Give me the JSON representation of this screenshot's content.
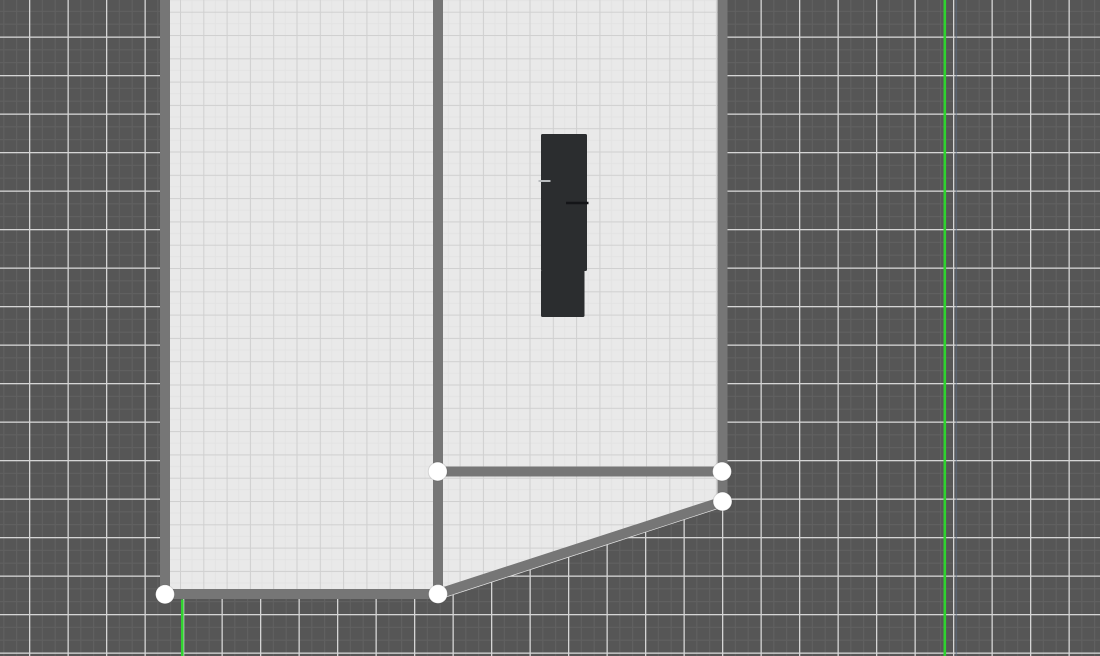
{
  "app": {
    "name": "floor-plan-editor",
    "view_label": "2d-plan-canvas"
  },
  "colors": {
    "workspace_base": "#565656",
    "workspace_minor_grid": "#616161",
    "workspace_major_grid": "#d5d5d5",
    "floor_base": "#e9e9e9",
    "floor_grid": "#d0d0d0",
    "floor_subgrid": "#e2e2e2",
    "wall": "#767676",
    "handle_fill": "#ffffff",
    "handle_edge": "rgba(0,0,0,0.12)",
    "furniture": "#2b2d2f",
    "guide_green": "#2fd32f",
    "aux_blue_line": "#5c6f8a"
  },
  "scene": {
    "canvas": {
      "width": 1100,
      "height": 656
    },
    "background_grid": {
      "minor_step": 12.83,
      "major_step": 38.5,
      "offset_x": 29,
      "offset_y": 36.5,
      "minor_line_w": 1,
      "major_line_w": 1.3
    },
    "floor_grid": {
      "step": 23.3,
      "offset_x": 16.9,
      "offset_y": 11.7,
      "line_w": 1,
      "subline_w": 0.8
    },
    "floor_polygon": "160,0 727,0 727,506 441,599 160,599",
    "walls": {
      "thickness": 10,
      "segments": [
        {
          "name": "wall-left",
          "x1": 165,
          "y1": 0,
          "x2": 165,
          "y2": 594
        },
        {
          "name": "wall-middle",
          "x1": 438,
          "y1": 0,
          "x2": 438,
          "y2": 594
        },
        {
          "name": "wall-right",
          "x1": 722.5,
          "y1": 0,
          "x2": 722.5,
          "y2": 501.5
        },
        {
          "name": "wall-divider",
          "x1": 438,
          "y1": 471.5,
          "x2": 722,
          "y2": 471.5
        },
        {
          "name": "wall-bottom",
          "x1": 165,
          "y1": 594,
          "x2": 438,
          "y2": 594
        },
        {
          "name": "wall-diagonal",
          "x1": 438,
          "y1": 594,
          "x2": 722.5,
          "y2": 501.5
        }
      ]
    },
    "furniture": {
      "name": "furniture-item",
      "parts": [
        {
          "x": 541,
          "y": 134,
          "w": 46,
          "h": 137
        },
        {
          "x": 541,
          "y": 270,
          "w": 43.5,
          "h": 47
        }
      ],
      "marks": [
        {
          "name": "furniture-mark-light",
          "x1": 538.5,
          "y1": 181,
          "x2": 550.5,
          "y2": 181,
          "color": "#b9bcbe",
          "w": 2
        },
        {
          "name": "furniture-mark-dark",
          "x1": 566,
          "y1": 203,
          "x2": 588.5,
          "y2": 203,
          "color": "#141518",
          "w": 2.4
        }
      ]
    },
    "handles": {
      "radius": 9.4,
      "points": [
        {
          "name": "vertex-handle-divider-left",
          "x": 437.7,
          "y": 471.5
        },
        {
          "name": "vertex-handle-divider-right",
          "x": 722,
          "y": 471.5
        },
        {
          "name": "vertex-handle-right-wall-end",
          "x": 722.5,
          "y": 501.5
        },
        {
          "name": "vertex-handle-bottom-middle",
          "x": 438,
          "y": 594
        },
        {
          "name": "vertex-handle-bottom-left",
          "x": 165,
          "y": 594.3
        }
      ]
    },
    "guides": {
      "width": 2.6,
      "lines": [
        {
          "name": "snap-guide-vertical-right",
          "x1": 944.8,
          "y1": 0,
          "x2": 944.8,
          "y2": 656
        },
        {
          "name": "snap-guide-vertical-left",
          "x1": 182.3,
          "y1": 599.5,
          "x2": 182.3,
          "y2": 656
        }
      ]
    },
    "aux_line": {
      "name": "blue-grid-line",
      "x": 956.3,
      "opacity": 0.5,
      "width": 1.6
    }
  }
}
